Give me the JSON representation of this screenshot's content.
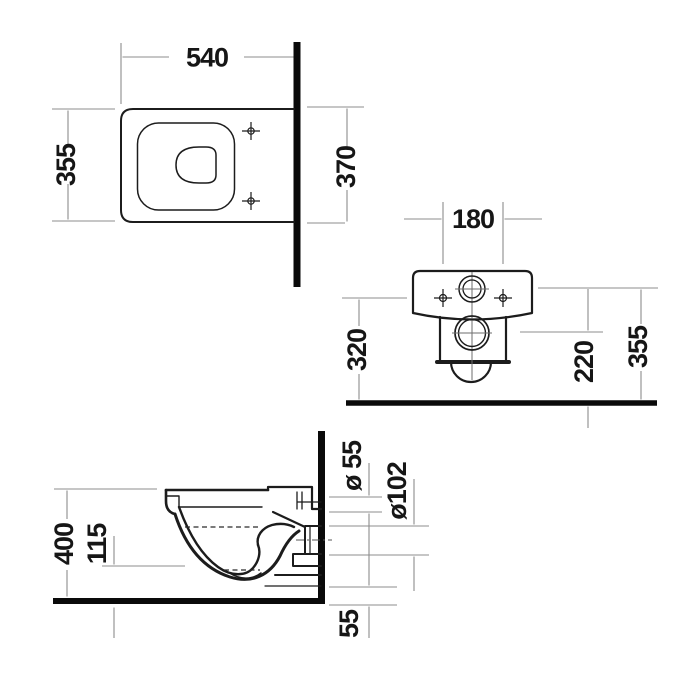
{
  "drawing": {
    "subject": "wall-hung toilet technical dimension drawing",
    "views": [
      "plan",
      "rear",
      "side"
    ]
  },
  "plan_view": {
    "dim_width": "540",
    "dim_depth": "355",
    "dim_wall_offset": "370"
  },
  "rear_view": {
    "dim_hole_spacing": "180",
    "dim_height_left": "320",
    "dim_outlet_height": "220",
    "dim_height_right": "355"
  },
  "side_view": {
    "dim_rim_height": "400",
    "dim_front_height": "115",
    "dim_inlet_diameter": "ø 55",
    "dim_outlet_diameter": "ø102",
    "dim_bottom_offset": "55"
  },
  "colors": {
    "background": "#ffffff",
    "outline": "#1c1c1c",
    "heavy_line": "#0a0a0a",
    "dimension_line": "#8c8c8c",
    "text": "#161616"
  }
}
